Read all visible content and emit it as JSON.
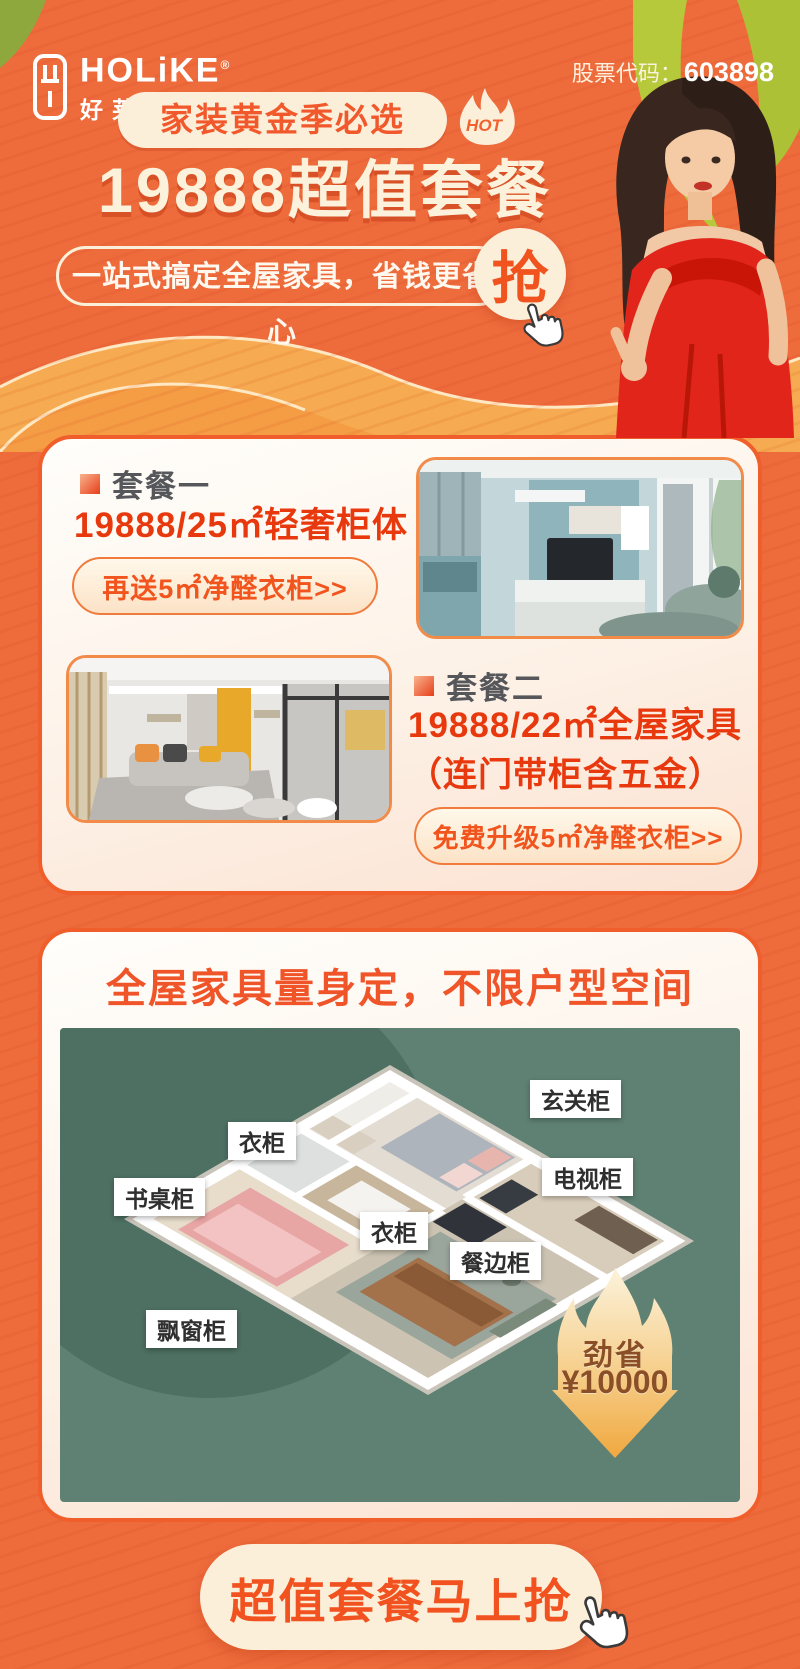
{
  "colors": {
    "bg_orange": "#EE6B3C",
    "card_border": "#F05E2B",
    "cream": "#FBEFD9",
    "accent_red": "#F1531F",
    "price_red": "#E8380D",
    "plan_green": "#5E8173",
    "savings_text_brown": "#8A4F26"
  },
  "header": {
    "brand": "HOLiKE",
    "reg_mark": "®",
    "brand_cn": "好莱客",
    "stock_label": "股票代码：",
    "stock_code": "603898"
  },
  "hero": {
    "badge": "家装黄金季必选",
    "hot_label": "HOT",
    "title": "19888超值套餐",
    "subtitle": "一站式搞定全屋家具，省钱更省心",
    "grab_label": "抢"
  },
  "packages": {
    "one": {
      "label": "套餐一",
      "price": "19888/25㎡轻奢柜体",
      "button": "再送5㎡净醛衣柜>>"
    },
    "two": {
      "label": "套餐二",
      "price_line1": "19888/22㎡全屋家具",
      "price_line2": "（连门带柜含五金）",
      "button": "免费升级5㎡净醛衣柜>>"
    }
  },
  "floorplan": {
    "title": "全屋家具量身定，不限户型空间",
    "labels": [
      "玄关柜",
      "衣柜",
      "电视柜",
      "书桌柜",
      "衣柜",
      "餐边柜",
      "飘窗柜"
    ],
    "savings": {
      "line1": "劲省",
      "line2": "¥10000"
    }
  },
  "cta": {
    "label": "超值套餐马上抢"
  }
}
